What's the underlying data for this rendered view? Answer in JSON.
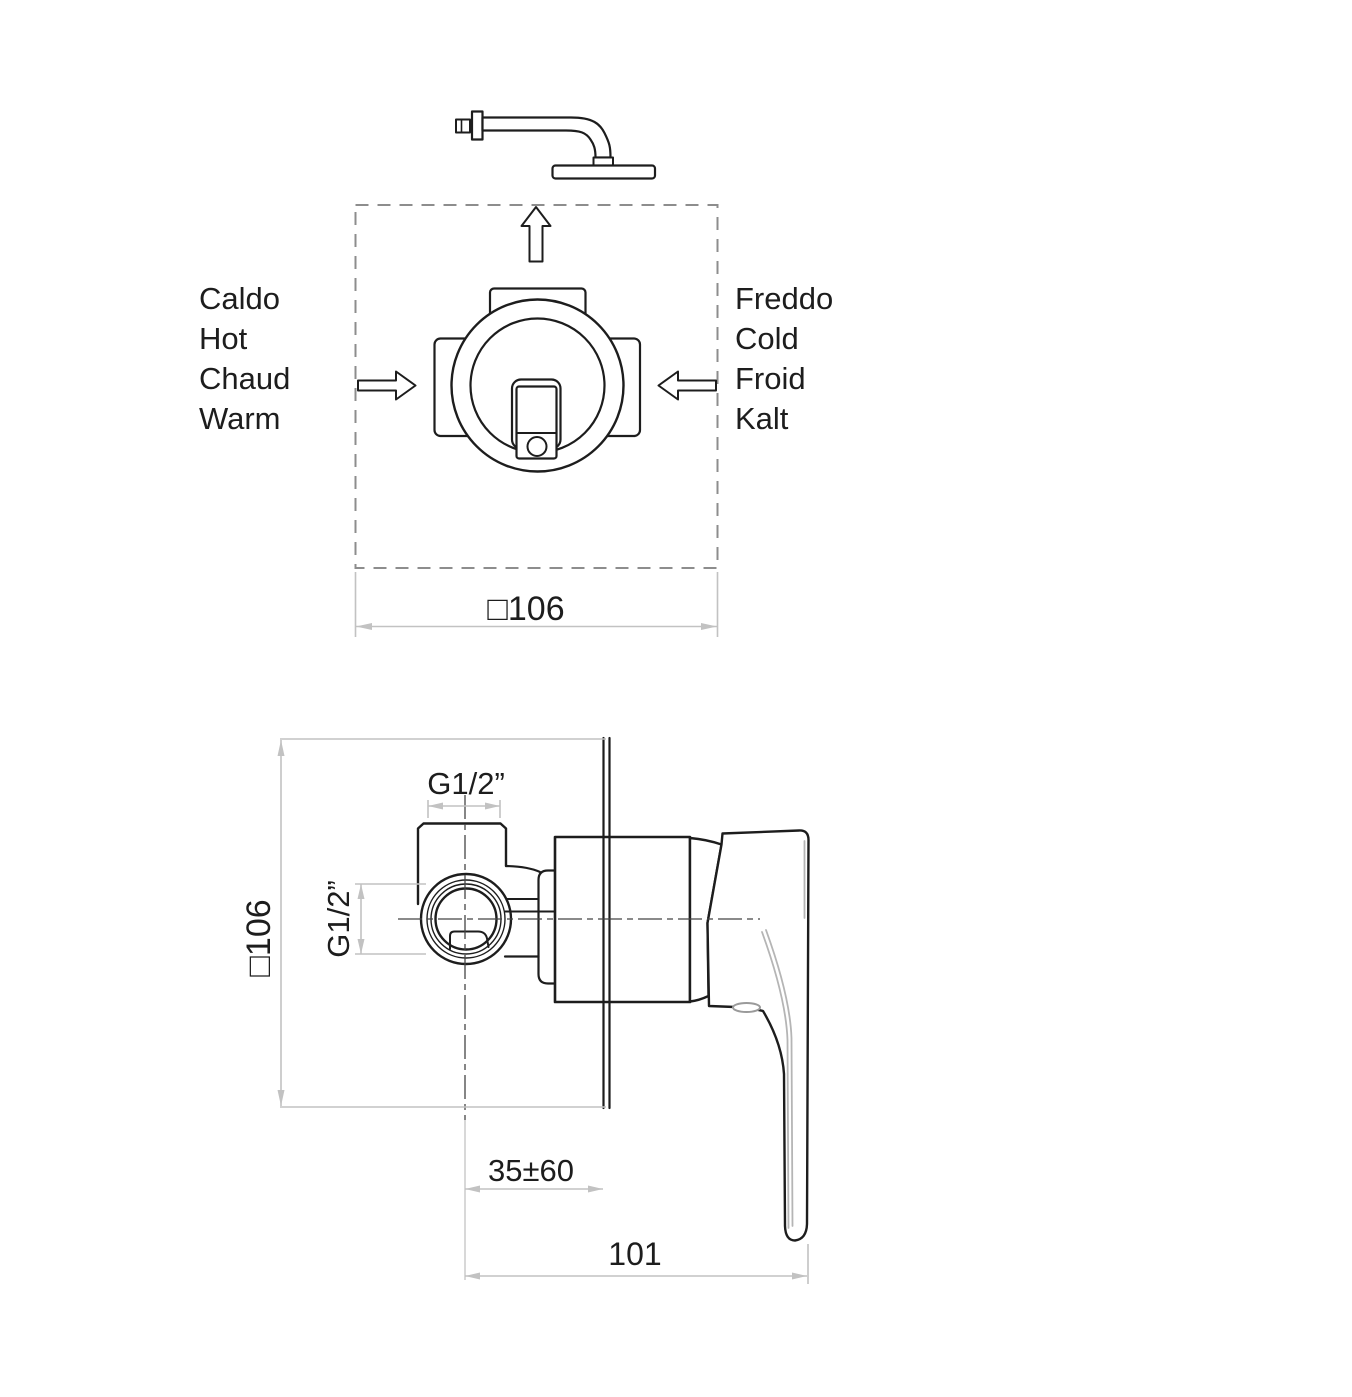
{
  "drawing": {
    "title_semantic": "concealed shower mixer installation diagram",
    "top_view": {
      "hot_labels": [
        "Caldo",
        "Hot",
        "Chaud",
        "Warm"
      ],
      "cold_labels": [
        "Freddo",
        "Cold",
        "Froid",
        "Kalt"
      ],
      "dim_width": "□106"
    },
    "front_view": {
      "dim_plate": "□106",
      "dim_thread_top": "G1/2”",
      "dim_thread_side": "G1/2”",
      "dim_depth": "35±60",
      "dim_projection": "101"
    },
    "colors": {
      "line": "#1d1d1d",
      "dimension": "#c2c2c2",
      "dashed_box": "#8d8d8d",
      "centerline": "#454545",
      "highlight": "#b5b5b5",
      "background": "#ffffff"
    }
  }
}
